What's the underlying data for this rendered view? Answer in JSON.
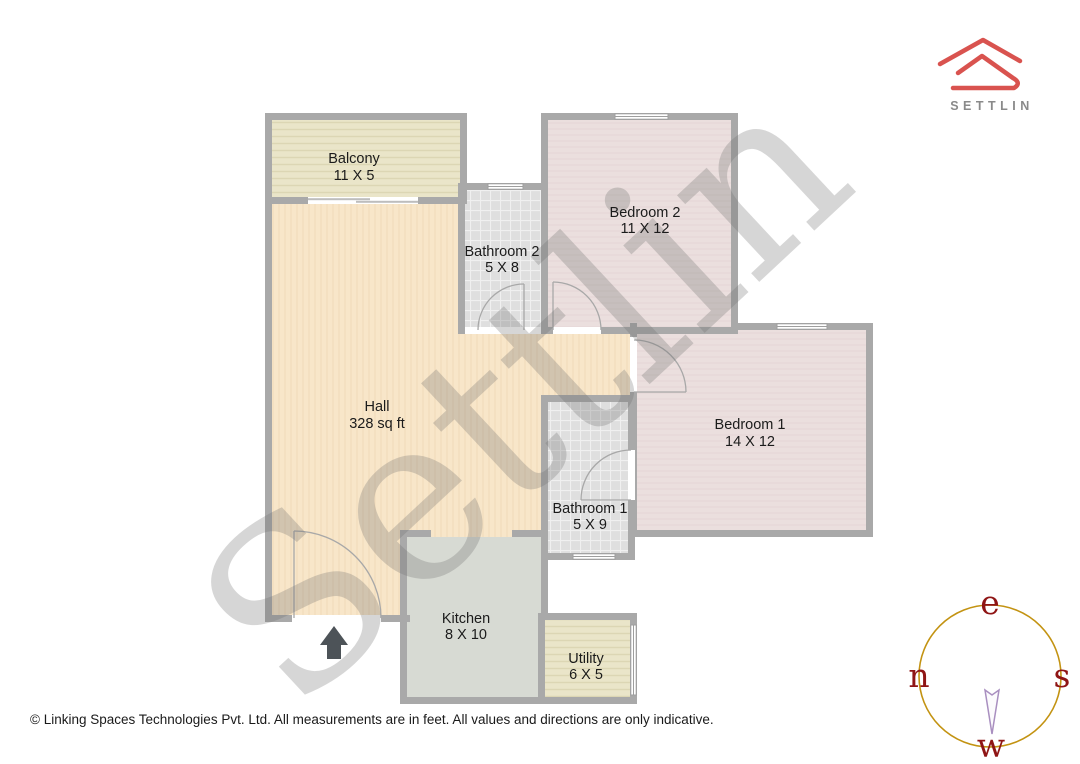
{
  "brand": {
    "name": "SETTLIN"
  },
  "watermark": "Settlin",
  "plan": {
    "rooms": [
      {
        "name": "Balcony",
        "dims": "11 X 5"
      },
      {
        "name": "Bathroom 2",
        "dims": "5 X 8"
      },
      {
        "name": "Bedroom 2",
        "dims": "11 X 12"
      },
      {
        "name": "Hall",
        "dims": "328 sq ft"
      },
      {
        "name": "Bedroom 1",
        "dims": "14 X 12"
      },
      {
        "name": "Bathroom 1",
        "dims": "5 X 9"
      },
      {
        "name": "Kitchen",
        "dims": "8 X 10"
      },
      {
        "name": "Utility",
        "dims": "6 X 5"
      }
    ]
  },
  "compass": {
    "top": "e",
    "right": "s",
    "bottom": "w",
    "left": "n"
  },
  "footer": {
    "text": "© Linking Spaces Technologies Pvt. Ltd. All measurements are in feet. All values and directions are only indicative."
  },
  "colors": {
    "wall": "#a9a9a9",
    "hall": "#f8e6c9",
    "bedroom": "#ebdfde",
    "bathroom": "#dfdfdf",
    "balcony": "#eae5c9",
    "kitchen": "#d7dad3",
    "logo_red": "#d9534f",
    "compass_ring": "#c39312",
    "compass_letters": "#8f1515"
  }
}
